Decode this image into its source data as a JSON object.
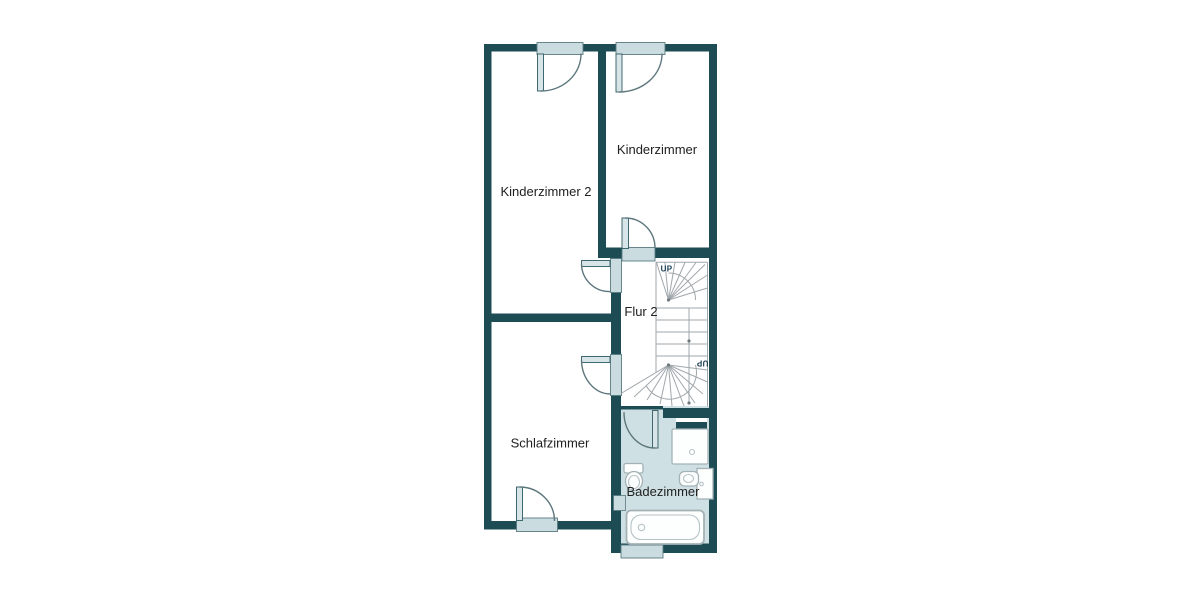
{
  "floorplan": {
    "type": "floor-plan",
    "floor_hint": "upper floor with winder staircase",
    "rooms": [
      {
        "label": "Kinderzimmer"
      },
      {
        "label": "Kinderzimmer 2"
      },
      {
        "label": "Flur 2"
      },
      {
        "label": "Schlafzimmer"
      },
      {
        "label": "Badezimmer"
      }
    ],
    "stairs": {
      "label_top": "UP",
      "label_bottom": "UP"
    },
    "fixtures": [
      {
        "name": "shower"
      },
      {
        "name": "toilet"
      },
      {
        "name": "sink"
      },
      {
        "name": "bathtub"
      },
      {
        "name": "radiator"
      }
    ],
    "colors": {
      "background": "#ffffff",
      "wall": "#1d4c54",
      "window": "#cbdce0",
      "door_leaf": "#d8e5e8",
      "door_arc": "#5d777c",
      "bathroom_floor": "#cfe0e4",
      "stair_lines": "#a0a7ab",
      "fixture_outline": "#a4b2b5",
      "room_label": "#212121",
      "up_label": "#16384e"
    }
  }
}
